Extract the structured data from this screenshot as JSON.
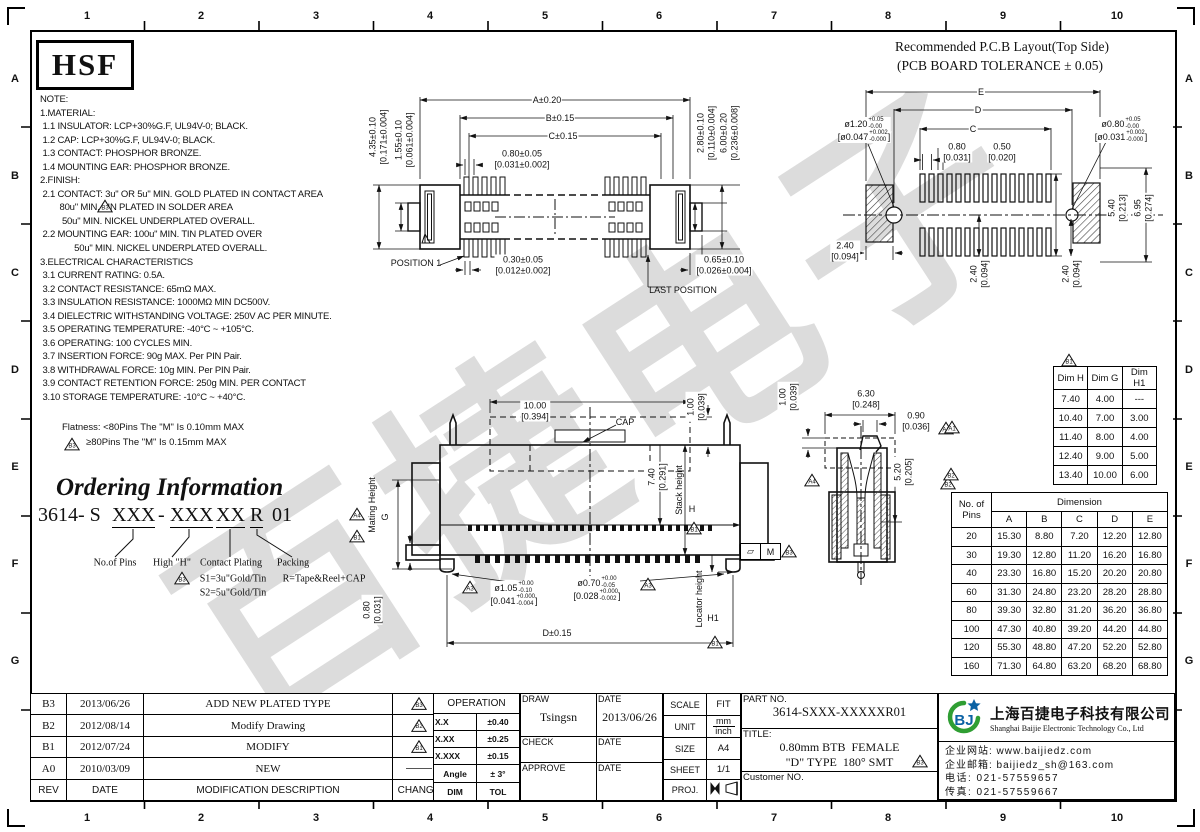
{
  "sheet": {
    "cols": [
      "1",
      "2",
      "3",
      "4",
      "5",
      "6",
      "7",
      "8",
      "9",
      "10"
    ],
    "rows": [
      "A",
      "B",
      "C",
      "D",
      "E",
      "F",
      "G"
    ],
    "logo": "HSF",
    "watermark": "百捷电子"
  },
  "notes": {
    "text": "NOTE:\n1.MATERIAL:\n 1.1 INSULATOR: LCP+30%G.F, UL94V-0; BLACK.\n 1.2 CAP: LCP+30%G.F, UL94V-0; BLACK.\n 1.3 CONTACT: PHOSPHOR BRONZE.\n 1.4 MOUNTING EAR: PHOSPHOR BRONZE.\n2.FINISH:\n 2.1 CONTACT: 3u\" OR 5u\" MIN. GOLD PLATED IN CONTACT AREA\n        80u\" MIN. TIN PLATED IN SOLDER AREA\n         50u\" MIN. NICKEL UNDERPLATED OVERALL.\n 2.2 MOUNTING EAR: 100u\" MIN. TIN PLATED OVER\n              50u\" MIN. NICKEL UNDERPLATED OVERALL.\n3.ELECTRICAL CHARACTERISTICS\n 3.1 CURRENT RATING: 0.5A.\n 3.2 CONTACT RESISTANCE: 65mΩ MAX.\n 3.3 INSULATION RESISTANCE: 1000MΩ MIN DC500V.\n 3.4 DIELECTRIC WITHSTANDING VOLTAGE: 250V AC PER MINUTE.\n 3.5 OPERATING TEMPERATURE: -40°C ~ +105°C.\n 3.6 OPERATING: 100 CYCLES MIN.\n 3.7 INSERTION FORCE: 90g MAX. Per PIN Pair.\n 3.8 WITHDRAWAL FORCE: 10g MIN. Per PIN Pair.\n 3.9 CONTACT RETENTION FORCE: 250g MIN. PER CONTACT\n 3.10 STORAGE TEMPERATURE: -10°C ~ +40°C."
  },
  "flatness": {
    "line1": "Flatness: <80Pins The \"M\" Is 0.10mm MAX",
    "line2": "≥80Pins The \"M\" Is 0.15mm MAX"
  },
  "ordering": {
    "heading": "Ordering Information",
    "prefix": "3614- S",
    "seg1": "XXX",
    "dash": "-",
    "seg2": "XXX",
    "seg3": "XX",
    "seg4": "R",
    "seg5": "01",
    "lbl_pins": "No.of Pins",
    "lbl_height": "High \"H\"",
    "lbl_plating": "Contact Plating",
    "lbl_packing": "Packing",
    "plating_s1": "S1=3u\"Gold/Tin",
    "plating_s2": "S2=5u\"Gold/Tin",
    "packing_r": "R=Tape&Reel+CAP"
  },
  "pcb": {
    "title1": "Recommended P.C.B Layout(Top Side)",
    "title2": "(PCB BOARD TOLERANCE ± 0.05)",
    "dim_e": "E",
    "dim_d": "D",
    "dim_c": "C",
    "pitch": "0.80\n[0.031]",
    "pad_w": "0.50\n[0.020]",
    "hole_l_main": "ø1.20",
    "hole_l_tp": "+0.05",
    "hole_l_tb": "-0.00",
    "hole_l_b": "[ø0.047",
    "hole_l_b_tp": "+0.002",
    "hole_l_b_tb": "-0.000",
    "hole_l_b_close": "]",
    "hole_r_main": "ø0.80",
    "hole_r_tp": "+0.05",
    "hole_r_tb": "-0.00",
    "hole_r_b": "[ø0.031",
    "hole_r_b_tp": "+0.002",
    "hole_r_b_tb": "-0.000",
    "hole_r_b_close": "]",
    "h540": "5.40\n[0.213]",
    "h695": "6.95\n[0.274]",
    "off240a": "2.40\n[0.094]",
    "off240b": "2.40\n[0.094]",
    "off240c": "2.40\n[0.094]"
  },
  "top_view": {
    "dim_a": "A±0.20",
    "dim_b": "B±0.15",
    "dim_c": "C±0.15",
    "pitch": "0.80±0.05\n[0.031±0.002]",
    "pin_w": "0.30±0.05\n[0.012±0.002]",
    "pos1": "POSITION 1",
    "last": "LAST POSITION",
    "h435": "4.35±0.10\n[0.171±0.004]",
    "h155": "1.55±0.10\n[0.061±0.004]",
    "h280": "2.80±0.10\n[0.110±0.004]",
    "h600": "6.00±0.20\n[0.236±0.008]",
    "d065": "0.65±0.10\n[0.026±0.004]"
  },
  "front_view": {
    "cap_w": "10.00\n[0.394]",
    "cap": "CAP",
    "cap_h": "1.00\n[0.039]",
    "h740": "7.40\n[0.291]",
    "stack": "Stack height",
    "stack_h": "H",
    "mating": "Mating Height",
    "mating_g": "G",
    "h080": "0.80\n[0.031]",
    "hole1_main": "ø1.05",
    "hole1_tp": "+0.00",
    "hole1_tb": "-0.10",
    "hole1_b": "[0.041",
    "hole1_b_tp": "+0.000",
    "hole1_b_tb": "-0.004",
    "hole1_b_close": "]",
    "hole2_main": "ø0.70",
    "hole2_tp": "+0.00",
    "hole2_tb": "-0.05",
    "hole2_b": "[0.028",
    "hole2_b_tp": "+0.000",
    "hole2_b_tb": "-0.002",
    "hole2_b_close": "]",
    "dim_d": "D±0.15",
    "locator": "Locator height",
    "locator_h1": "H1",
    "fcf_sym": "▱",
    "fcf_m": "M"
  },
  "side_view": {
    "w630": "6.30\n[0.248]",
    "cap_h": "1.00\n[0.039]",
    "tip": "0.90\n[0.036]",
    "depth": "5.20\n[0.205]"
  },
  "flags": {
    "a1": "A1",
    "a3": "A3",
    "a4": "A4",
    "b1": "B1",
    "b2": "B2",
    "b3": "B3"
  },
  "dim_table": {
    "headers": [
      "Dim H",
      "Dim G",
      "Dim H1"
    ],
    "rows": [
      [
        "7.40",
        "4.00",
        "---"
      ],
      [
        "10.40",
        "7.00",
        "3.00"
      ],
      [
        "11.40",
        "8.00",
        "4.00"
      ],
      [
        "12.40",
        "9.00",
        "5.00"
      ],
      [
        "13.40",
        "10.00",
        "6.00"
      ]
    ]
  },
  "pins_table": {
    "corner": "No. of\nPins",
    "dim_header": "Dimension",
    "cols": [
      "A",
      "B",
      "C",
      "D",
      "E"
    ],
    "rows": [
      [
        "20",
        "15.30",
        "8.80",
        "7.20",
        "12.20",
        "12.80"
      ],
      [
        "30",
        "19.30",
        "12.80",
        "11.20",
        "16.20",
        "16.80"
      ],
      [
        "40",
        "23.30",
        "16.80",
        "15.20",
        "20.20",
        "20.80"
      ],
      [
        "60",
        "31.30",
        "24.80",
        "23.20",
        "28.20",
        "28.80"
      ],
      [
        "80",
        "39.30",
        "32.80",
        "31.20",
        "36.20",
        "36.80"
      ],
      [
        "100",
        "47.30",
        "40.80",
        "39.20",
        "44.20",
        "44.80"
      ],
      [
        "120",
        "55.30",
        "48.80",
        "47.20",
        "52.20",
        "52.80"
      ],
      [
        "160",
        "71.30",
        "64.80",
        "63.20",
        "68.20",
        "68.80"
      ]
    ]
  },
  "revisions": {
    "h_rev": "REV",
    "h_date": "DATE",
    "h_desc": "MODIFICATION  DESCRIPTION",
    "h_change": "CHANGE",
    "rows": [
      {
        "rev": "B3",
        "date": "2013/06/26",
        "desc": "ADD NEW PLATED TYPE"
      },
      {
        "rev": "B2",
        "date": "2012/08/14",
        "desc": "Modify Drawing"
      },
      {
        "rev": "B1",
        "date": "2012/07/24",
        "desc": "MODIFY"
      },
      {
        "rev": "A0",
        "date": "2010/03/09",
        "desc": "NEW"
      }
    ]
  },
  "tolerance": {
    "header": "OPERATION",
    "rows": [
      [
        "X.X",
        "±0.40"
      ],
      [
        "X.XX",
        "±0.25"
      ],
      [
        "X.XXX",
        "±0.15"
      ],
      [
        "Angle",
        "± 3°"
      ],
      [
        "DIM",
        "TOL"
      ]
    ]
  },
  "approval": {
    "draw": "DRAW",
    "draw_name": "Tsingsn",
    "date1": "DATE",
    "draw_date": "2013/06/26",
    "check": "CHECK",
    "date2": "DATE",
    "approve": "APPROVE",
    "date3": "DATE"
  },
  "info": {
    "scale": "SCALE",
    "scale_v": "FIT",
    "unit": "UNIT",
    "unit_mm": "mm",
    "unit_inch": "inch",
    "size": "SIZE",
    "size_v": "A4",
    "sheet": "SHEET",
    "sheet_v": "1/1",
    "proj": "PROJ."
  },
  "part": {
    "no_label": "PART NO.",
    "no": "3614-SXXX-XXXXXR01",
    "title_label": "TITLE:",
    "title1": "0.80mm BTB  FEMALE",
    "title2": "\"D\" TYPE  180° SMT",
    "customer": "Customer NO."
  },
  "company": {
    "logo_b": "BJ",
    "cn": "上海百捷电子科技有限公司",
    "en": "Shanghai Baijie Electronic Technology Co., Ltd",
    "web": "企业网站: www.baijiedz.com",
    "mail": "企业邮箱: baijiedz_sh@163.com",
    "tel": "电话: 021-57559657",
    "fax": "传真: 021-57559667"
  }
}
